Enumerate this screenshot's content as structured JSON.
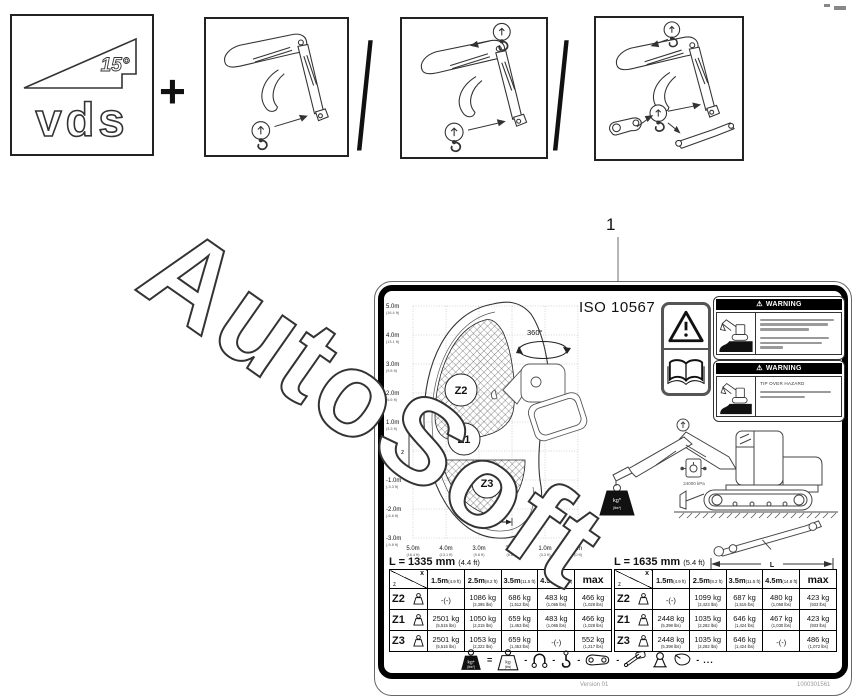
{
  "watermark_text": "AutoSoft",
  "top_row": {
    "plus": "+",
    "slash": "/",
    "vds": {
      "label": "vds",
      "angle": "15°"
    }
  },
  "callout": {
    "number": "1"
  },
  "label": {
    "iso_text": "ISO 10567",
    "rotation_text": "360°",
    "warning_glyph": "⚠",
    "axis": {
      "z_letter": "z",
      "x_letter": "x",
      "y_labels": [
        {
          "m": "5.0m",
          "ft": "(16.4 ft)"
        },
        {
          "m": "4.0m",
          "ft": "(13.1 ft)"
        },
        {
          "m": "3.0m",
          "ft": "(9.8 ft)"
        },
        {
          "m": "2.0m",
          "ft": "(6.6 ft)"
        },
        {
          "m": "1.0m",
          "ft": "(3.3 ft)"
        },
        {
          "m": "0m",
          "ft": "(0 ft)"
        },
        {
          "m": "-1.0m",
          "ft": "(-3.3 ft)"
        },
        {
          "m": "-2.0m",
          "ft": "(-6.6 ft)"
        },
        {
          "m": "-3.0m",
          "ft": "(-9.8 ft)"
        }
      ],
      "x_labels": [
        {
          "m": "5.0m",
          "ft": "(16.4 ft)"
        },
        {
          "m": "4.0m",
          "ft": "(13.1 ft)"
        },
        {
          "m": "3.0m",
          "ft": "(9.8 ft)"
        },
        {
          "m": "2.0m",
          "ft": "(6.6 ft)"
        },
        {
          "m": "1.0m",
          "ft": "(3.3 ft)"
        },
        {
          "m": "0m",
          "ft": "(0 ft)"
        }
      ]
    },
    "zones": {
      "z1": "Z1",
      "z2": "Z2",
      "z3": "Z3"
    },
    "pressure_label": "24000 kPa",
    "weight_black": {
      "line1": "kg*",
      "line2": "(lbs*)"
    },
    "weight_white": {
      "line1": "kg",
      "line2": "(lbs)"
    },
    "dimension_letter": "L",
    "warning1": {
      "header": "WARNING"
    },
    "warning2": {
      "header": "WARNING",
      "title": "TIP OVER HAZARD"
    },
    "tables": [
      {
        "title_mm": "L = 1335 mm",
        "title_ft": "(4.4 ft)",
        "corner": {
          "x": "x",
          "z": "z"
        },
        "col_headers": [
          {
            "main": "1.5m",
            "sub": "(4.9 ft)"
          },
          {
            "main": "2.5m",
            "sub": "(8.2 ft)"
          },
          {
            "main": "3.5m",
            "sub": "(11.5 ft)"
          },
          {
            "main": "4.5m",
            "sub": "(14.8 ft)"
          },
          {
            "main": "max",
            "sub": ""
          }
        ],
        "rows": [
          {
            "zone": "Z2",
            "cells": [
              {
                "kg": "-(-)",
                "lbs": ""
              },
              {
                "kg": "1086 kg",
                "lbs": "(2,395 lbs)"
              },
              {
                "kg": "686 kg",
                "lbs": "(1,512 lbs)"
              },
              {
                "kg": "483 kg",
                "lbs": "(1,065 lbs)"
              },
              {
                "kg": "466 kg",
                "lbs": "(1,028 lbs)"
              }
            ]
          },
          {
            "zone": "Z1",
            "cells": [
              {
                "kg": "2501 kg",
                "lbs": "(5,515 lbs)"
              },
              {
                "kg": "1050 kg",
                "lbs": "(2,315 lbs)"
              },
              {
                "kg": "659 kg",
                "lbs": "(1,453 lbs)"
              },
              {
                "kg": "483 kg",
                "lbs": "(1,065 lbs)"
              },
              {
                "kg": "466 kg",
                "lbs": "(1,028 lbs)"
              }
            ]
          },
          {
            "zone": "Z3",
            "cells": [
              {
                "kg": "2501 kg",
                "lbs": "(5,515 lbs)"
              },
              {
                "kg": "1053 kg",
                "lbs": "(2,322 lbs)"
              },
              {
                "kg": "659 kg",
                "lbs": "(1,453 lbs)"
              },
              {
                "kg": "-(-)",
                "lbs": ""
              },
              {
                "kg": "552 kg",
                "lbs": "(1,217 lbs)"
              }
            ]
          }
        ]
      },
      {
        "title_mm": "L = 1635 mm",
        "title_ft": "(5.4 ft)",
        "corner": {
          "x": "x",
          "z": "z"
        },
        "col_headers": [
          {
            "main": "1.5m",
            "sub": "(4.9 ft)"
          },
          {
            "main": "2.5m",
            "sub": "(8.2 ft)"
          },
          {
            "main": "3.5m",
            "sub": "(11.5 ft)"
          },
          {
            "main": "4.5m",
            "sub": "(14.8 ft)"
          },
          {
            "main": "max",
            "sub": ""
          }
        ],
        "rows": [
          {
            "zone": "Z2",
            "cells": [
              {
                "kg": "-(-)",
                "lbs": ""
              },
              {
                "kg": "1099 kg",
                "lbs": "(2,423 lbs)"
              },
              {
                "kg": "687 kg",
                "lbs": "(1,515 lbs)"
              },
              {
                "kg": "480 kg",
                "lbs": "(1,058 lbs)"
              },
              {
                "kg": "423 kg",
                "lbs": "(933 lbs)"
              }
            ]
          },
          {
            "zone": "Z1",
            "cells": [
              {
                "kg": "2448 kg",
                "lbs": "(5,398 lbs)"
              },
              {
                "kg": "1035 kg",
                "lbs": "(2,282 lbs)"
              },
              {
                "kg": "646 kg",
                "lbs": "(1,424 lbs)"
              },
              {
                "kg": "467 kg",
                "lbs": "(1,030 lbs)"
              },
              {
                "kg": "423 kg",
                "lbs": "(933 lbs)"
              }
            ]
          },
          {
            "zone": "Z3",
            "cells": [
              {
                "kg": "2448 kg",
                "lbs": "(5,398 lbs)"
              },
              {
                "kg": "1035 kg",
                "lbs": "(2,282 lbs)"
              },
              {
                "kg": "646 kg",
                "lbs": "(1,424 lbs)"
              },
              {
                "kg": "-(-)",
                "lbs": ""
              },
              {
                "kg": "486 kg",
                "lbs": "(1,072 lbs)"
              }
            ]
          }
        ]
      }
    ],
    "legend": {
      "equals": "=",
      "dash": "-",
      "ellipsis": "..."
    },
    "footer": {
      "version": "Version 01",
      "code": "1000301561"
    }
  }
}
